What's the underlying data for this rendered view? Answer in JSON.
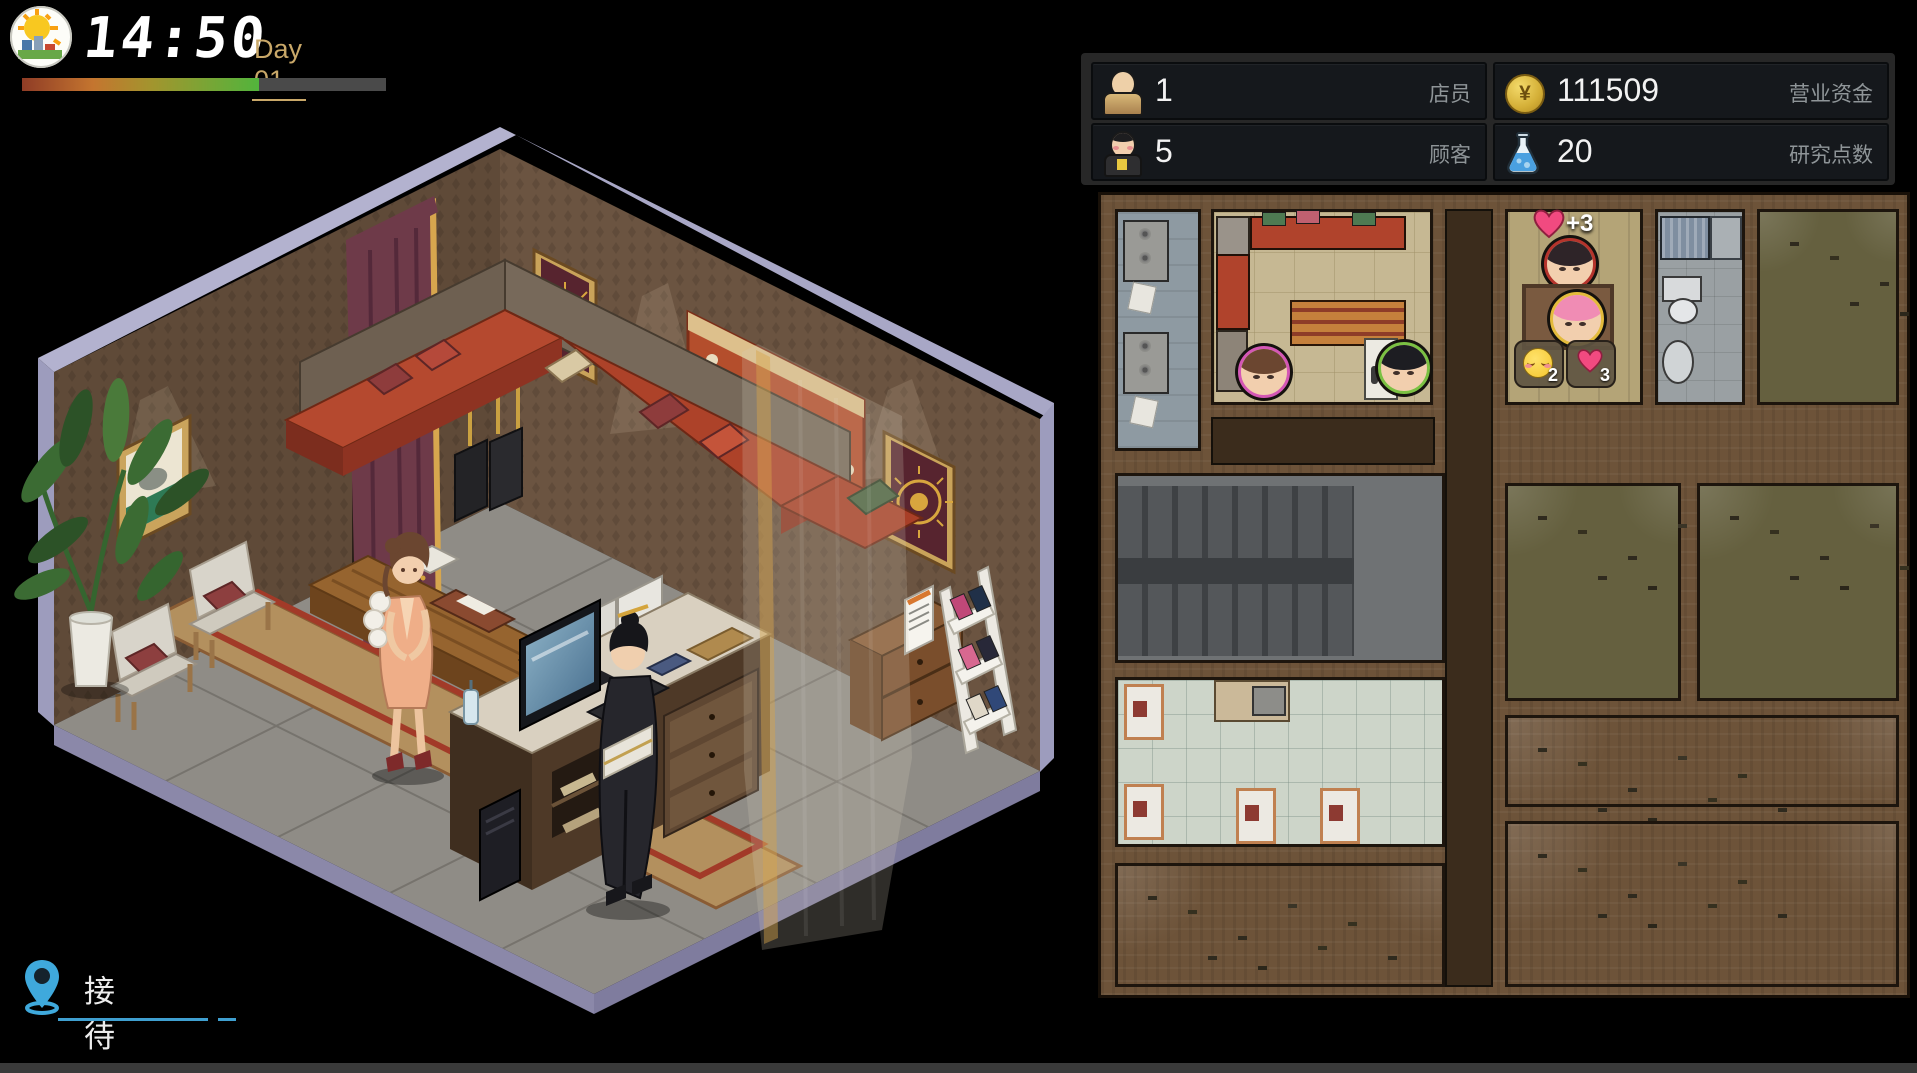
{
  "header": {
    "time": "14:50",
    "day_label": "Day 01",
    "progress_percent": 65
  },
  "stats": {
    "staff": {
      "value": "1",
      "label": "店员"
    },
    "funds": {
      "symbol": "¥",
      "value": "111509",
      "label": "营业资金"
    },
    "customers": {
      "value": "5",
      "label": "顾客"
    },
    "research": {
      "value": "20",
      "label": "研究点数"
    }
  },
  "minimap": {
    "heart_gain": "+3",
    "mood_value": "2",
    "heart_value": "3"
  },
  "location": {
    "name": "接待室"
  },
  "colors": {
    "accent_blue": "#3fa9dc",
    "day_text": "#c9a869",
    "heart_pink": "#f2487e",
    "progress_green": "#52b43c"
  }
}
